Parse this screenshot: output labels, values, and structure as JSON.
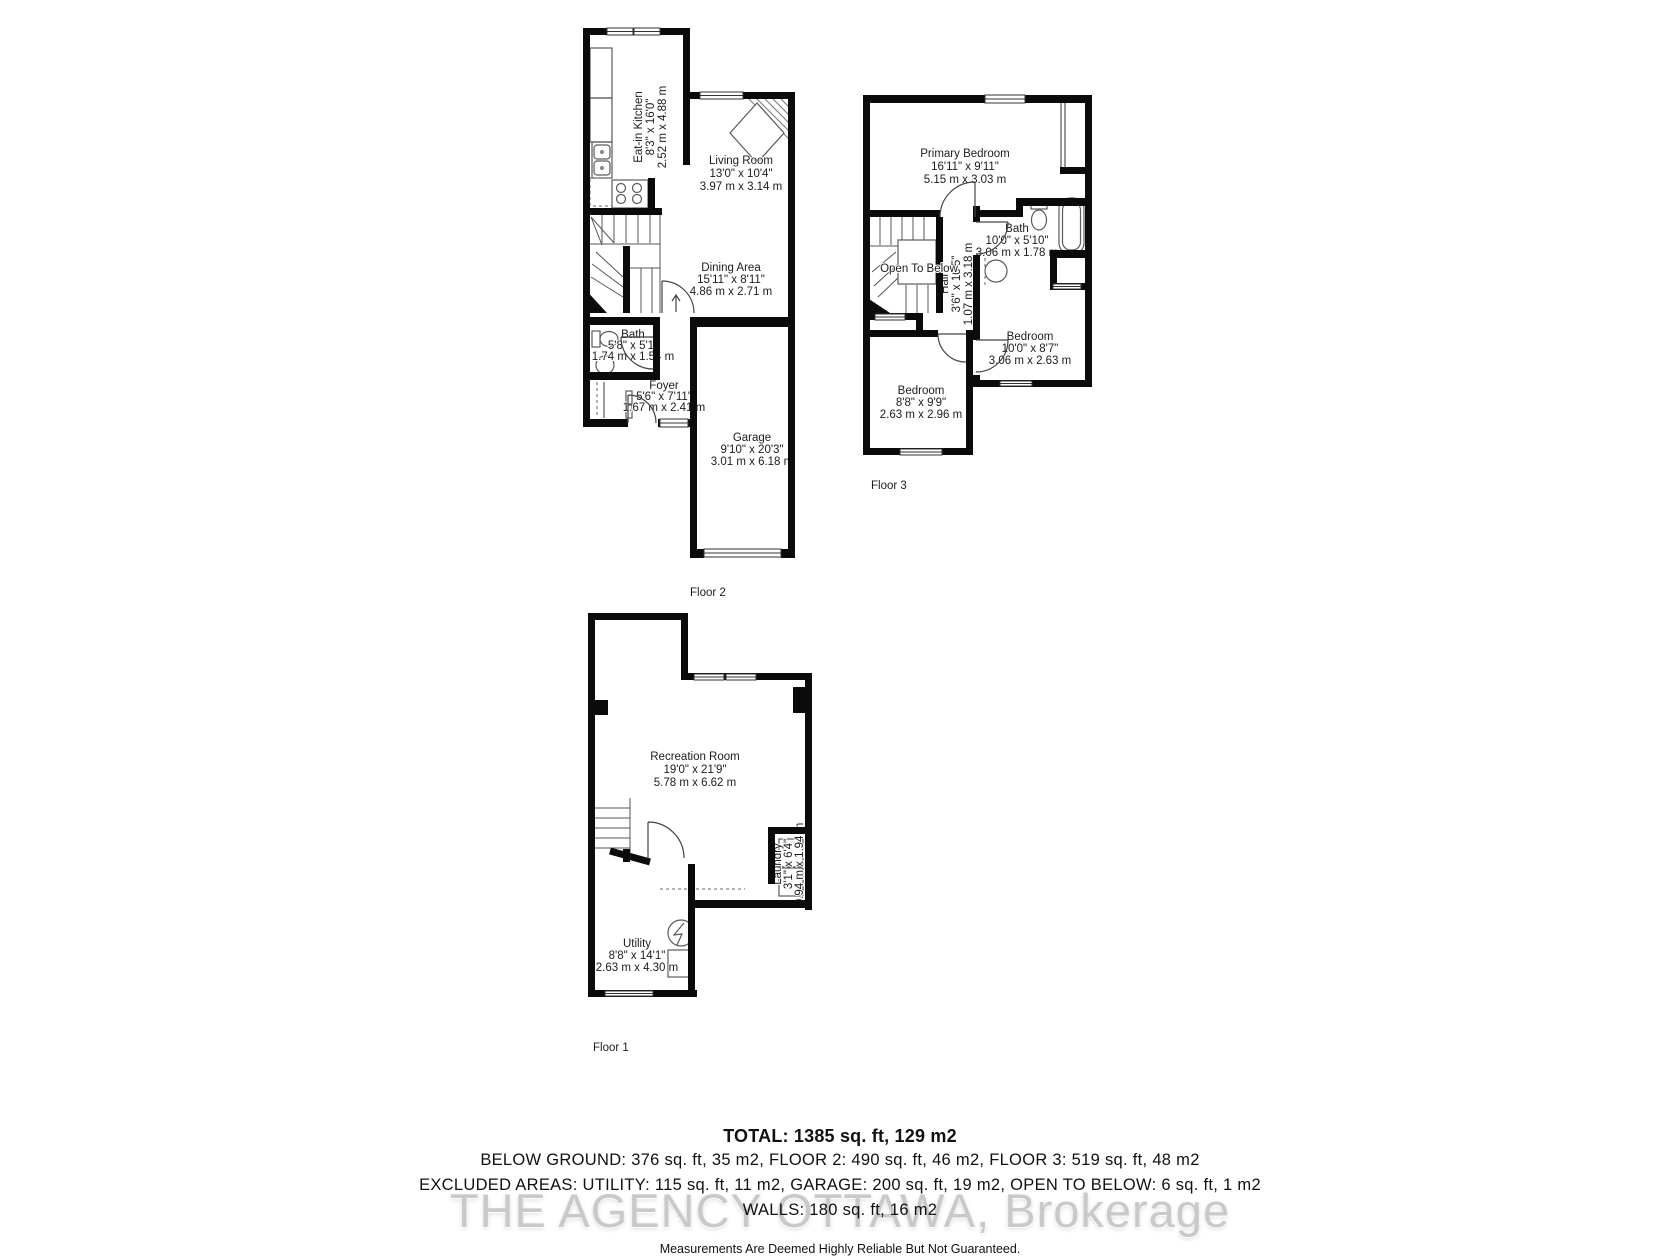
{
  "floors": {
    "floor2": {
      "label": "Floor 2",
      "rooms": {
        "kitchen": {
          "name": "Eat-in Kitchen",
          "imperial": "8'3\" x 16'0\"",
          "metric": "2.52 m x 4.88 m"
        },
        "living": {
          "name": "Living Room",
          "imperial": "13'0\" x 10'4\"",
          "metric": "3.97 m x 3.14 m"
        },
        "dining": {
          "name": "Dining Area",
          "imperial": "15'11\" x 8'11\"",
          "metric": "4.86 m x 2.71 m"
        },
        "bath": {
          "name": "Bath",
          "imperial": "5'8\" x 5'1\"",
          "metric": "1.74 m x 1.54 m"
        },
        "foyer": {
          "name": "Foyer",
          "imperial": "5'6\" x 7'11\"",
          "metric": "1.67 m x 2.41 m"
        },
        "garage": {
          "name": "Garage",
          "imperial": "9'10\" x 20'3\"",
          "metric": "3.01 m x 6.18 m"
        }
      }
    },
    "floor3": {
      "label": "Floor 3",
      "rooms": {
        "primary": {
          "name": "Primary Bedroom",
          "imperial": "16'11\" x 9'11\"",
          "metric": "5.15 m x 3.03 m"
        },
        "bath": {
          "name": "Bath",
          "imperial": "10'0\" x 5'10\"",
          "metric": "3.06 m x 1.78 m"
        },
        "open_below": {
          "name": "Open To Below"
        },
        "hall": {
          "name": "Hall",
          "imperial": "3'6\" x 10'5\"",
          "metric": "1.07 m x 3.18 m"
        },
        "bedroom_left": {
          "name": "Bedroom",
          "imperial": "8'8\" x 9'9\"",
          "metric": "2.63 m x 2.96 m"
        },
        "bedroom_right": {
          "name": "Bedroom",
          "imperial": "10'0\" x 8'7\"",
          "metric": "3.06 m x 2.63 m"
        }
      }
    },
    "floor1": {
      "label": "Floor 1",
      "rooms": {
        "recreation": {
          "name": "Recreation Room",
          "imperial": "19'0\" x 21'9\"",
          "metric": "5.78 m x 6.62 m"
        },
        "laundry": {
          "name": "Laundry",
          "imperial": "3'1\" x 6'4\"",
          "metric": "0.94 m x 1.94 m"
        },
        "utility": {
          "name": "Utility",
          "imperial": "8'8\" x 14'1\"",
          "metric": "2.63 m x 4.30 m"
        }
      }
    }
  },
  "summary": {
    "total": "TOTAL: 1385 sq. ft, 129 m2",
    "line2": "BELOW GROUND: 376 sq. ft, 35 m2, FLOOR 2: 490 sq. ft, 46 m2, FLOOR 3: 519 sq. ft, 48 m2",
    "line3": "EXCLUDED AREAS: UTILITY: 115 sq. ft, 11 m2, GARAGE: 200 sq. ft, 19 m2, OPEN TO BELOW: 6 sq. ft, 1 m2",
    "line4": "WALLS: 180 sq. ft, 16 m2",
    "disclaimer": "Measurements Are Deemed Highly Reliable But Not Guaranteed."
  },
  "watermark": "THE AGENCY OTTAWA, Brokerage",
  "colors": {
    "wall": "#0b0b0b",
    "label": "#1c1c1c",
    "watermark": "#c9c9c9"
  }
}
